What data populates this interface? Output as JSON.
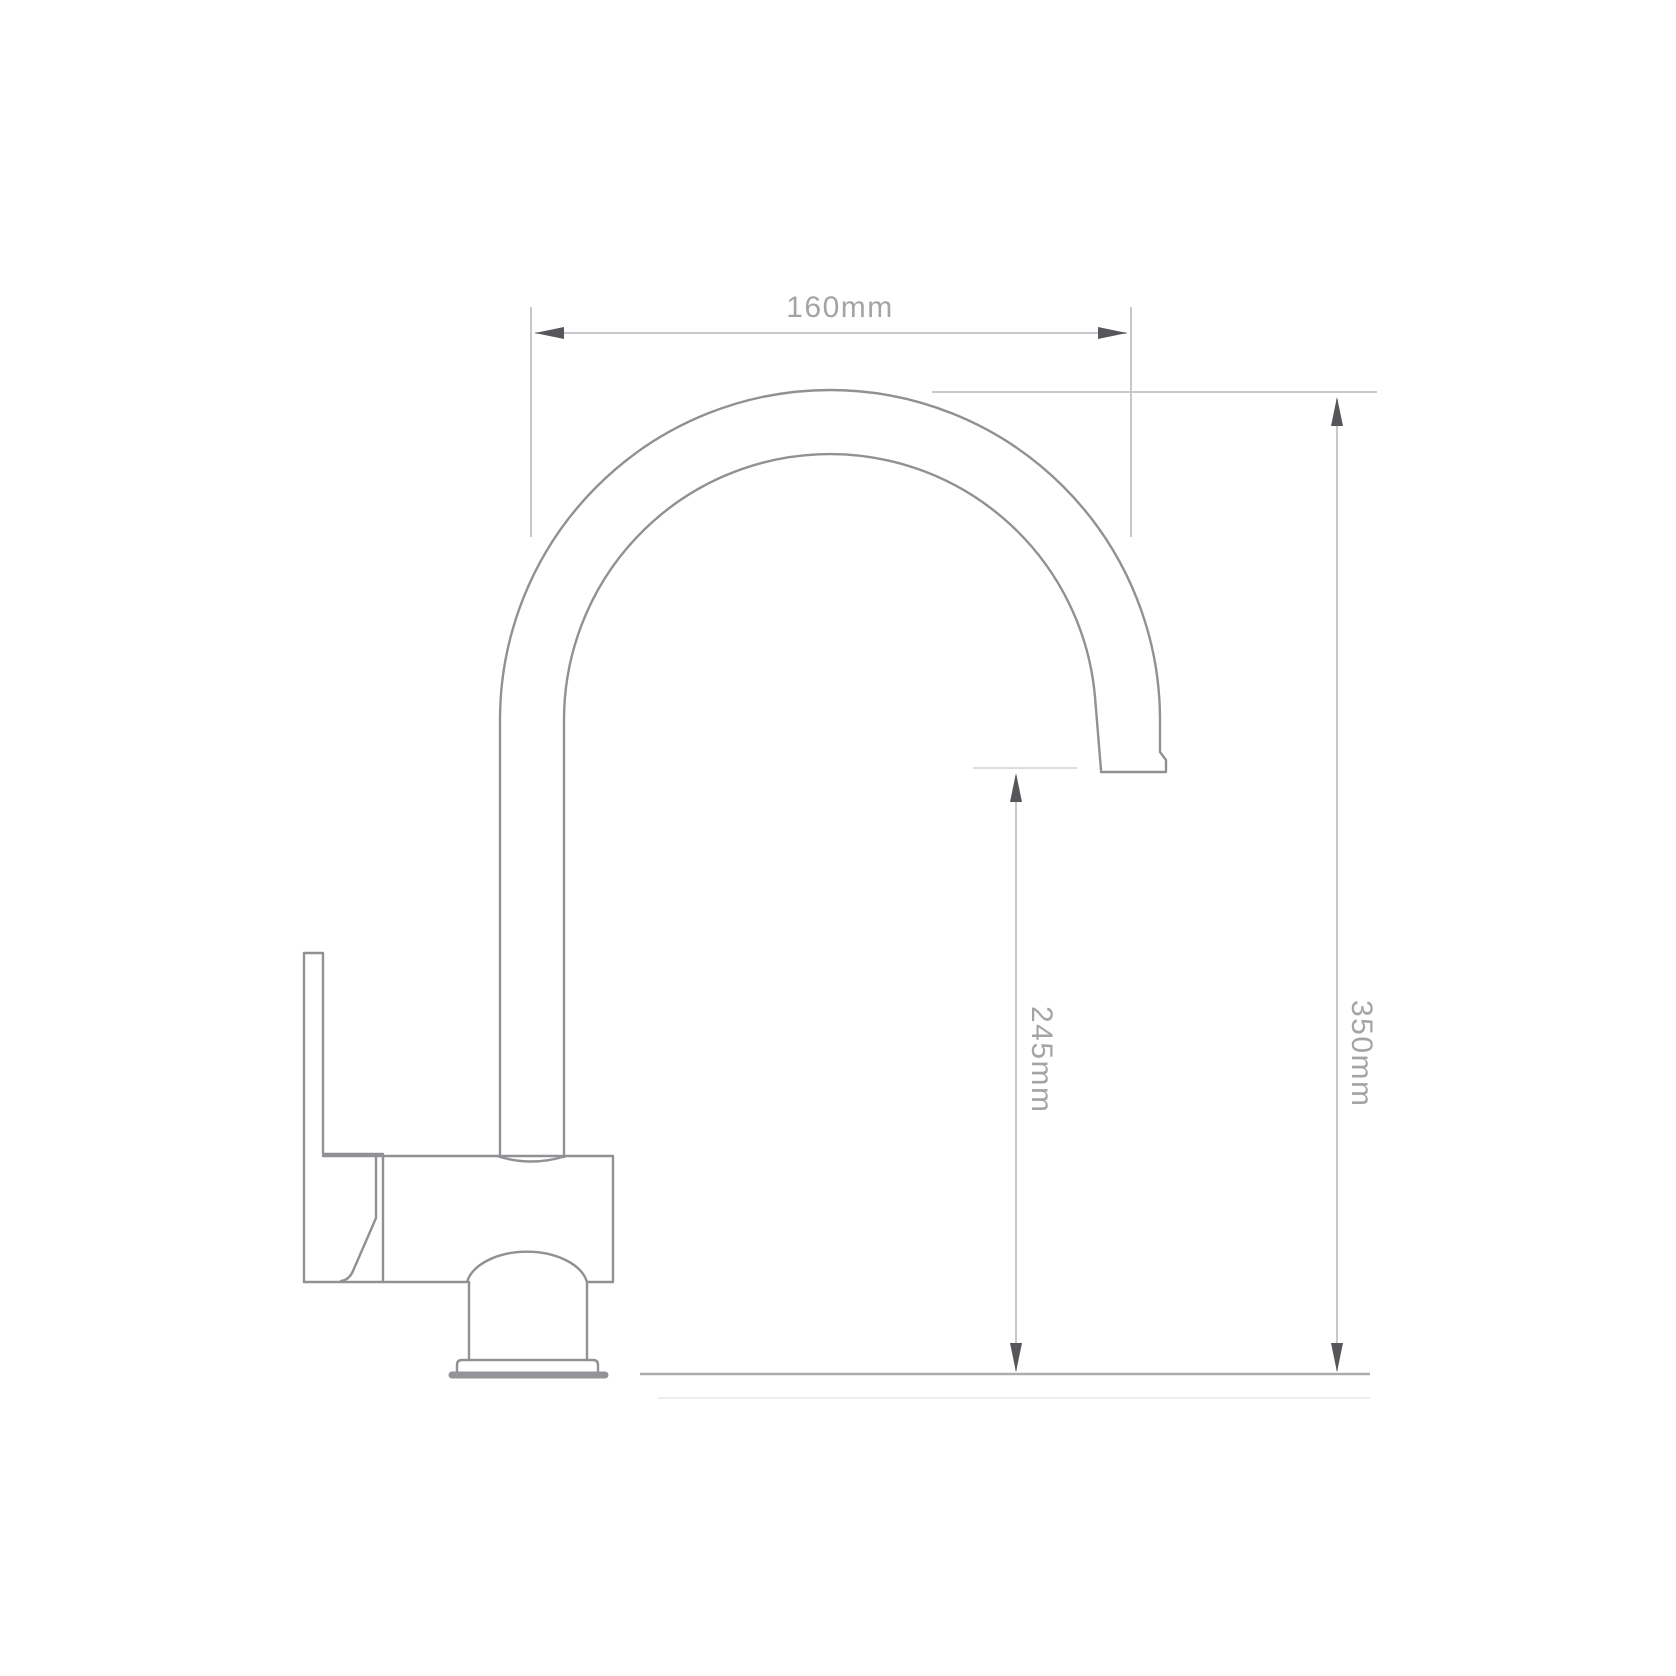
{
  "drawing": {
    "dimensions": {
      "spout_reach": "160mm",
      "spout_clearance": "245mm",
      "overall_height": "350mm"
    },
    "colors": {
      "background": "#ffffff",
      "outline": "#8f9194",
      "dimension_line": "#c6c8cb",
      "extension_tick": "#dcdde0",
      "ground_line": "#aaacaf",
      "arrow": "#56575a",
      "label_text": "#a2a4a8"
    }
  }
}
